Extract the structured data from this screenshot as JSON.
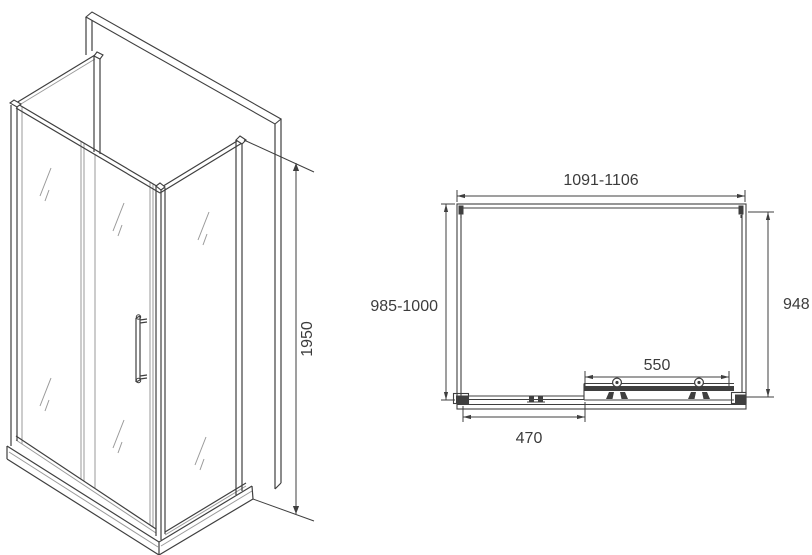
{
  "colors": {
    "line": "#3f3f3f",
    "line_light": "#9a9a9a",
    "text": "#3c3c3c",
    "background": "#ffffff"
  },
  "isometric_view": {
    "height_label": "1950"
  },
  "plan_view": {
    "width_label": "1091-1106",
    "depth_label": "985-1000",
    "right_depth_label": "948",
    "door_width_label": "550",
    "side_offset_label": "470"
  }
}
